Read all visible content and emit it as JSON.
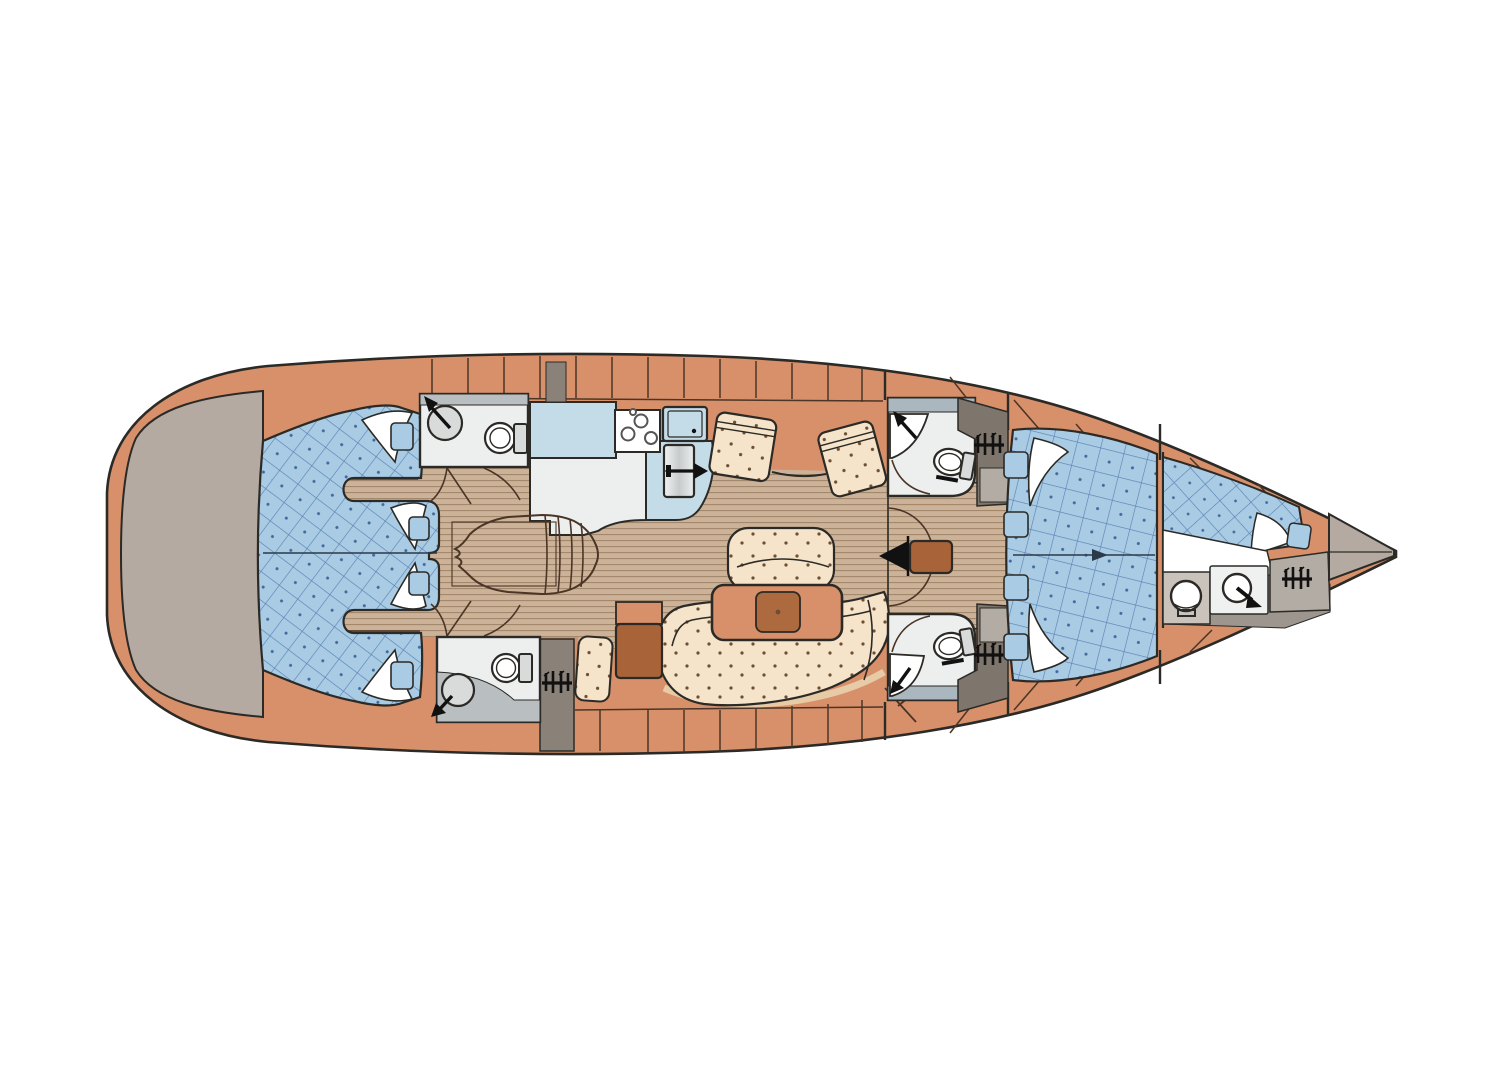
{
  "canvas": {
    "width": 1492,
    "height": 1080
  },
  "diagram": {
    "type": "sailing-yacht-interior-floor-plan",
    "orientation": "bow-right-stern-left",
    "view": "top-down",
    "text_labels": [],
    "regions": [
      {
        "id": "transom-platform",
        "kind": "deck"
      },
      {
        "id": "aft-cabin-starboard",
        "kind": "cabin-with-double-berth"
      },
      {
        "id": "aft-cabin-port",
        "kind": "cabin-with-double-berth"
      },
      {
        "id": "aft-head-starboard",
        "kind": "bathroom-shower-toilet"
      },
      {
        "id": "aft-head-port",
        "kind": "bathroom-shower-toilet"
      },
      {
        "id": "galley",
        "kind": "kitchen-stove-sink-fridge"
      },
      {
        "id": "companionway-steps",
        "kind": "stairs"
      },
      {
        "id": "salon",
        "kind": "settees-table-bench"
      },
      {
        "id": "nav-station",
        "kind": "chart-table-seat"
      },
      {
        "id": "forward-head-starboard",
        "kind": "bathroom-shower-toilet"
      },
      {
        "id": "forward-head-port",
        "kind": "bathroom-shower-toilet"
      },
      {
        "id": "mast-passage",
        "kind": "corridor-with-doors"
      },
      {
        "id": "owner-cabin",
        "kind": "cabin-with-v-berth"
      },
      {
        "id": "fore-cabin",
        "kind": "berth-vanity-toilet-wardrobe"
      },
      {
        "id": "anchor-locker",
        "kind": "bow-locker"
      }
    ],
    "icons": [
      "shower-icon",
      "toilet-icon",
      "hangers-icon",
      "stove-burners-icon",
      "sink-icon",
      "fridge-arrow-icon",
      "mast-icon",
      "centerline-arrow-icon",
      "companionway-steps-icon",
      "washbasin-icon"
    ]
  },
  "colors": {
    "pageBg": "#ffffff",
    "hull": "#d8906a",
    "hullLine": "#2b2a26",
    "transom": "#b4aaa1",
    "berth": "#a9cbe4",
    "quiltLine": "#557fb2",
    "quiltDot": "#41699c",
    "wood": "#cbb299",
    "woodLine": "#a08467",
    "cushion": "#f5e4c9",
    "cushionDot": "#6b4e33",
    "counter": "#c4dbe8",
    "surface": "#edefef",
    "fixture": "#d9dbdb",
    "headFloor": "#b9bec1",
    "headFloorCool": "#aab7be",
    "lockerDark": "#7e766c",
    "lockerMid": "#8a8179",
    "lockerLight": "#b3aca4",
    "tableBrown": "#ad6a3e",
    "navBrown": "#a96338",
    "trim": "#e7cba6",
    "line": "#4a3526",
    "black": "#111111",
    "white": "#ffffff",
    "grayFloor": "#9d968e",
    "vanity": "#cac3bb",
    "toiletBox": "#eff1f1",
    "arrowBlue": "#2b3a4a"
  }
}
